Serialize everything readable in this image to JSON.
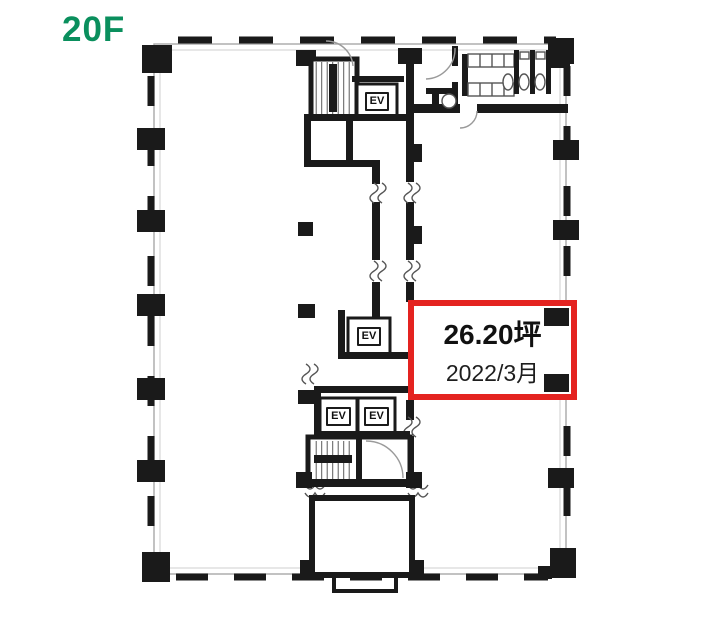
{
  "floor_label": "20F",
  "unit_highlight": {
    "area": "26.20坪",
    "available": "2022/3月"
  },
  "elevators": {
    "labels": [
      "EV",
      "EV",
      "EV",
      "EV"
    ]
  },
  "colors": {
    "floor_label": "#0a8f5d",
    "highlight_border": "#e42320",
    "walls": "#1a1a1a"
  },
  "plan_features": {
    "upper_core": "staircase-and-elevator",
    "top_right": "restrooms",
    "center": "corridor",
    "middle_core": "elevator-hall",
    "lower_core": "staircase",
    "bottom_center": "service-room",
    "highlighted_room": "vacant-unit"
  }
}
